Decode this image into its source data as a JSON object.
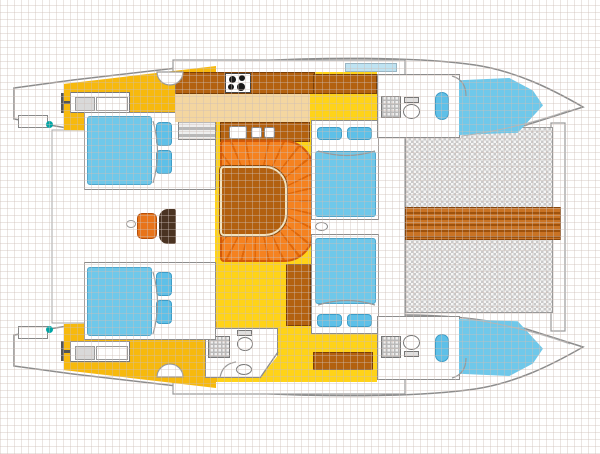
{
  "diagram": {
    "title": "Catamaran interior layout plan (top view)",
    "type": "boat-floor-plan",
    "orientation": {
      "bow": "right",
      "stern": "left"
    }
  },
  "rooms": {
    "saloon": "Saloon with U-shaped dinette and table",
    "galley": "Galley with stove and twin sinks",
    "cockpit": "Aft cockpit",
    "trampoline": "Bow trampoline net",
    "foredeck_walkway": "Foredeck plank walkway",
    "port_aft_cabin": "Port aft double cabin",
    "port_mid_cabin": "Port forward double cabin",
    "starboard_aft_cabin": "Starboard aft double cabin",
    "starboard_mid_cabin": "Starboard forward double cabin",
    "port_bow_berth": "Port bow berth",
    "starboard_bow_berth": "Starboard bow berth",
    "port_fwd_head": "Port forward bathroom",
    "starboard_fwd_head": "Starboard forward bathroom",
    "aft_head": "Aft bathroom with shower, toilet and basin",
    "port_stern_platform": "Port stern swim platform",
    "starboard_stern_platform": "Starboard stern swim platform"
  },
  "features": [
    "boarding-ladder-icon",
    "transom-step",
    "cleat-dot",
    "engine-hatch",
    "companionway-steps",
    "stove-burners-icon",
    "galley-sinks",
    "shower-pan-icon",
    "toilet-icon",
    "basin-icon",
    "vanity-sink",
    "nav-seat",
    "nav-console",
    "door-arc",
    "sliding-door-handle",
    "coachroof-window-strip",
    "forward-crossbeam"
  ],
  "colors": {
    "deck-yellow": "#F7B90D",
    "floor-yellow": "#FFD318",
    "walkway-beige": "#F4D6A0",
    "counter-brown": "#B3610F",
    "table-brown": "#B2600F",
    "plank-brown": "#C97324",
    "plank-dark": "#9E520D",
    "settee-orange": "#F58220",
    "settee-seam": "#E06708",
    "settee-border": "#D2590A",
    "bed-blue": "#6FC8EA",
    "pillow-blue": "#5EC0E8",
    "window-blue": "#BFE3F2",
    "mesh-gray": "#C9C9C9",
    "outline-gray": "#8C8C8C",
    "cleat-teal": "#00A5A5"
  }
}
